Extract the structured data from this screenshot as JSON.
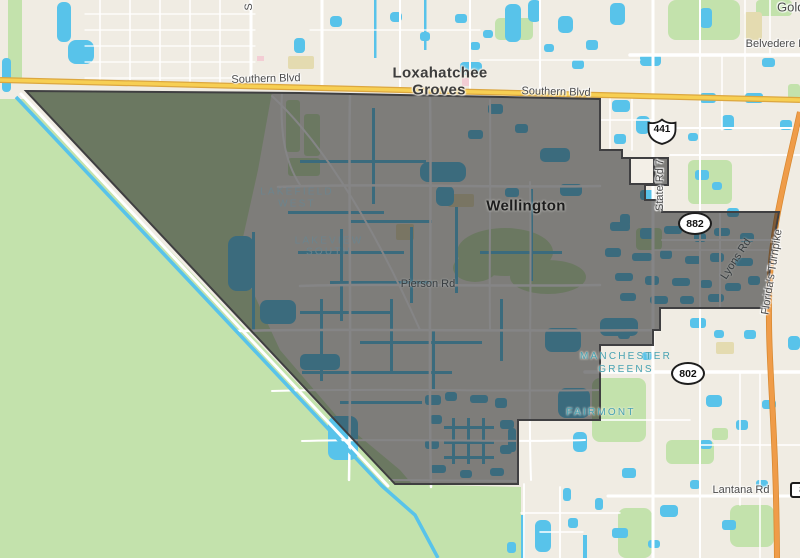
{
  "colors": {
    "background": "#f0ece3",
    "greenspace": "#c3e2ac",
    "water": "#58c3ea",
    "overlay_fill": "rgba(38,38,40,0.56)",
    "overlay_stroke": "#3f3f41",
    "highway_yellow": "#f7cf53",
    "turnpike_orange": "#ef9c49",
    "neighborhood_teal": "#47a2b2"
  },
  "city_labels": {
    "loxahatchee_groves": {
      "line1": "Loxahatchee",
      "line2": "Groves"
    },
    "wellington": "Wellington"
  },
  "road_labels": {
    "southern_blvd": "Southern Blvd",
    "belvedere_rd": "Belvedere Rd",
    "state_rd_7": "State Rd 7",
    "pierson_rd": "Pierson Rd",
    "lyons_rd": "Lyons Rd",
    "floridas_turnpike": "Florida's Turnpike",
    "lantana_rd": "Lantana Rd",
    "partial_top": "S",
    "partial_top_right": "Gold"
  },
  "neighborhood_labels": {
    "lakefield_west": {
      "line1": "LAKEFIELD",
      "line2": "WEST"
    },
    "lakeview_south": {
      "line1": "LAKEVIEW",
      "line2": "SOUTH"
    },
    "manchester_greens": {
      "line1": "MANCHESTER",
      "line2": "GREENS"
    },
    "fairmont": "FAIRMONT"
  },
  "route_shields": {
    "us_441": "441",
    "fl_882": "882",
    "fl_802": "802",
    "partial_right": "8"
  }
}
